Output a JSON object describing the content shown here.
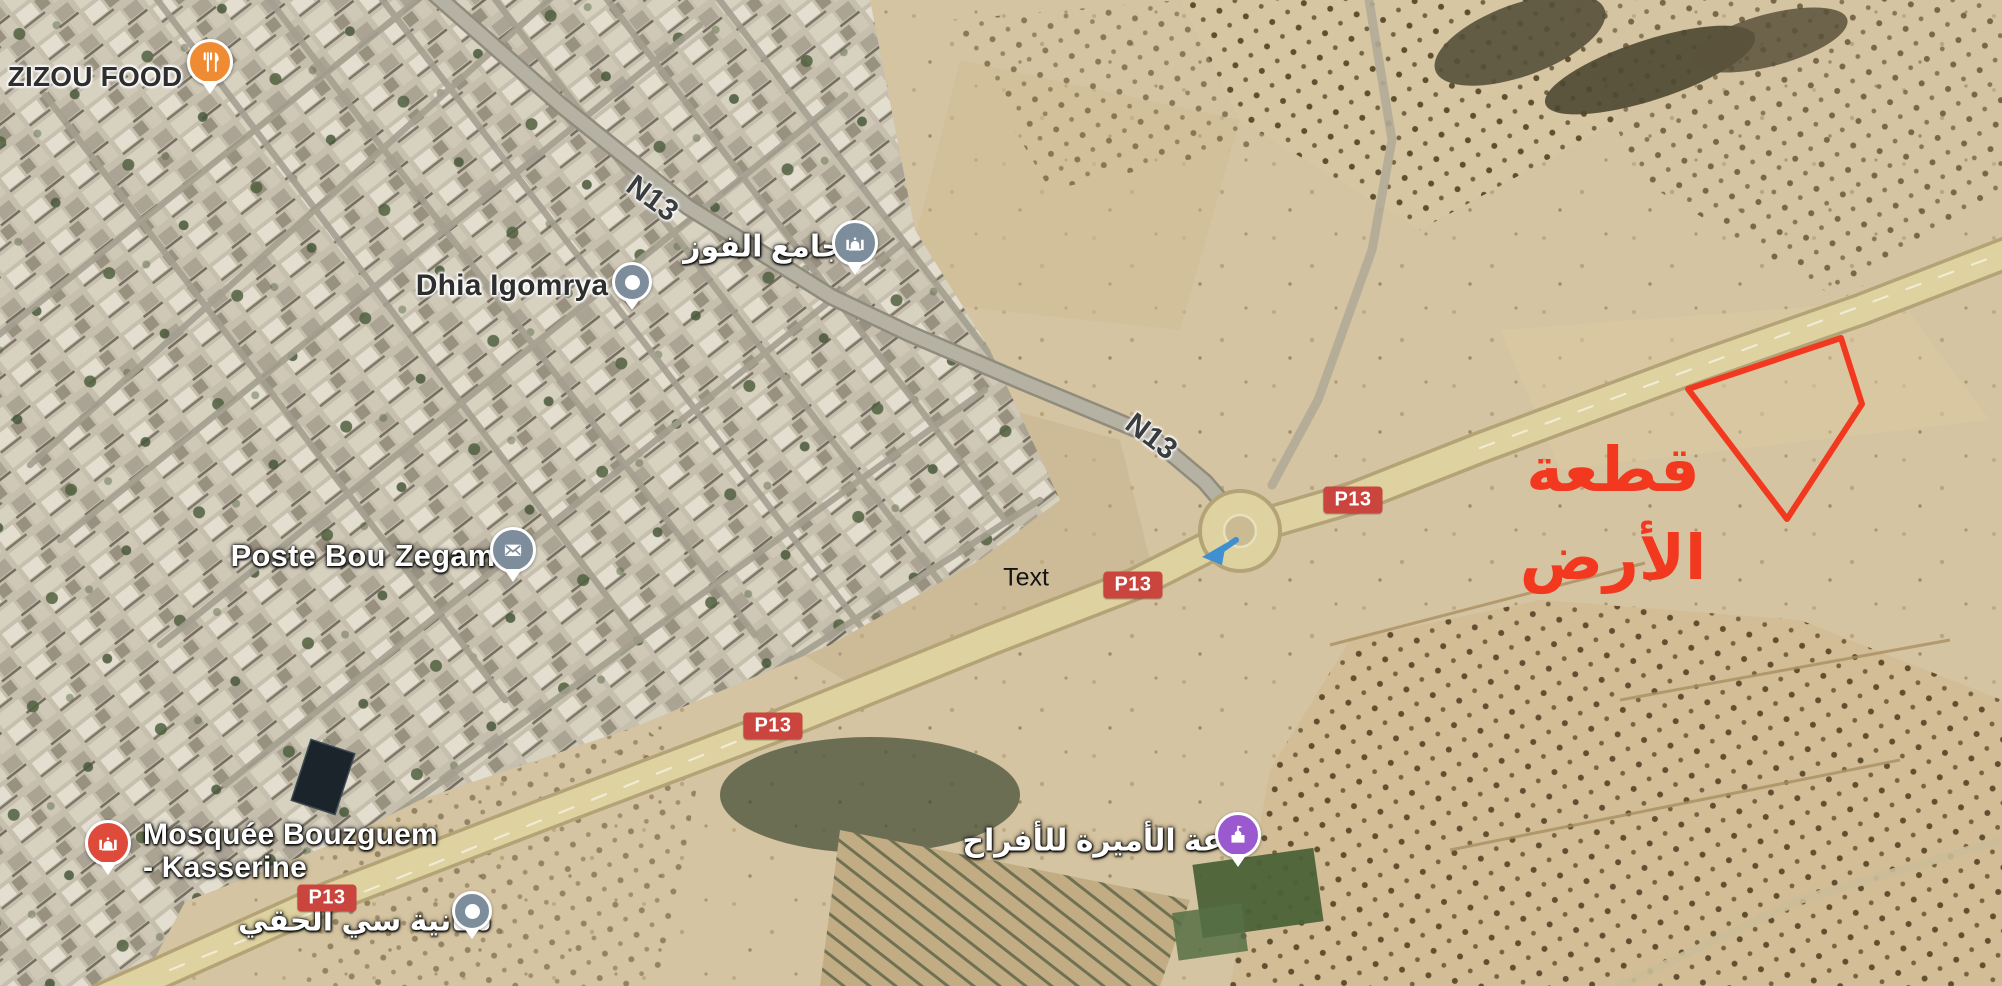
{
  "map": {
    "pois": [
      {
        "label": "ZIZOU FOOD",
        "icon": "restaurant-icon",
        "pin_color": "#ef8c33"
      },
      {
        "label": "جامع الفوز",
        "icon": "mosque-icon",
        "pin_color": "#7d8d9c"
      },
      {
        "label": "Dhia Igomrya",
        "icon": "dot-icon",
        "pin_color": "#7d8d9c"
      },
      {
        "label": "Poste Bou Zegam",
        "icon": "mail-icon",
        "pin_color": "#7d8d9c"
      },
      {
        "label": "Mosquée Bouzguem",
        "label_line2": "- Kasserine",
        "icon": "mosque-icon",
        "pin_color": "#de4b3b"
      },
      {
        "label": "سانية سي الحقي",
        "icon": "dot-icon",
        "pin_color": "#7d8d9c"
      },
      {
        "label": "قاعة الأميرة للأفراح",
        "icon": "event-icon",
        "pin_color": "#9b59d0"
      }
    ],
    "road_labels": [
      "N13",
      "N13"
    ],
    "badges": [
      "P13",
      "P13",
      "P13",
      "P13"
    ],
    "note": "Text",
    "parcel_annotation": {
      "line1": "قطعة",
      "line2": "الأرض"
    },
    "colors": {
      "annotation_red": "#f2391f",
      "badge_red": "#c9453e",
      "highlighted_road": "#ded2a0",
      "pin_orange": "#ef8c33",
      "pin_slate": "#7d8d9c",
      "pin_red": "#de4b3b",
      "pin_purple": "#9b59d0"
    }
  }
}
